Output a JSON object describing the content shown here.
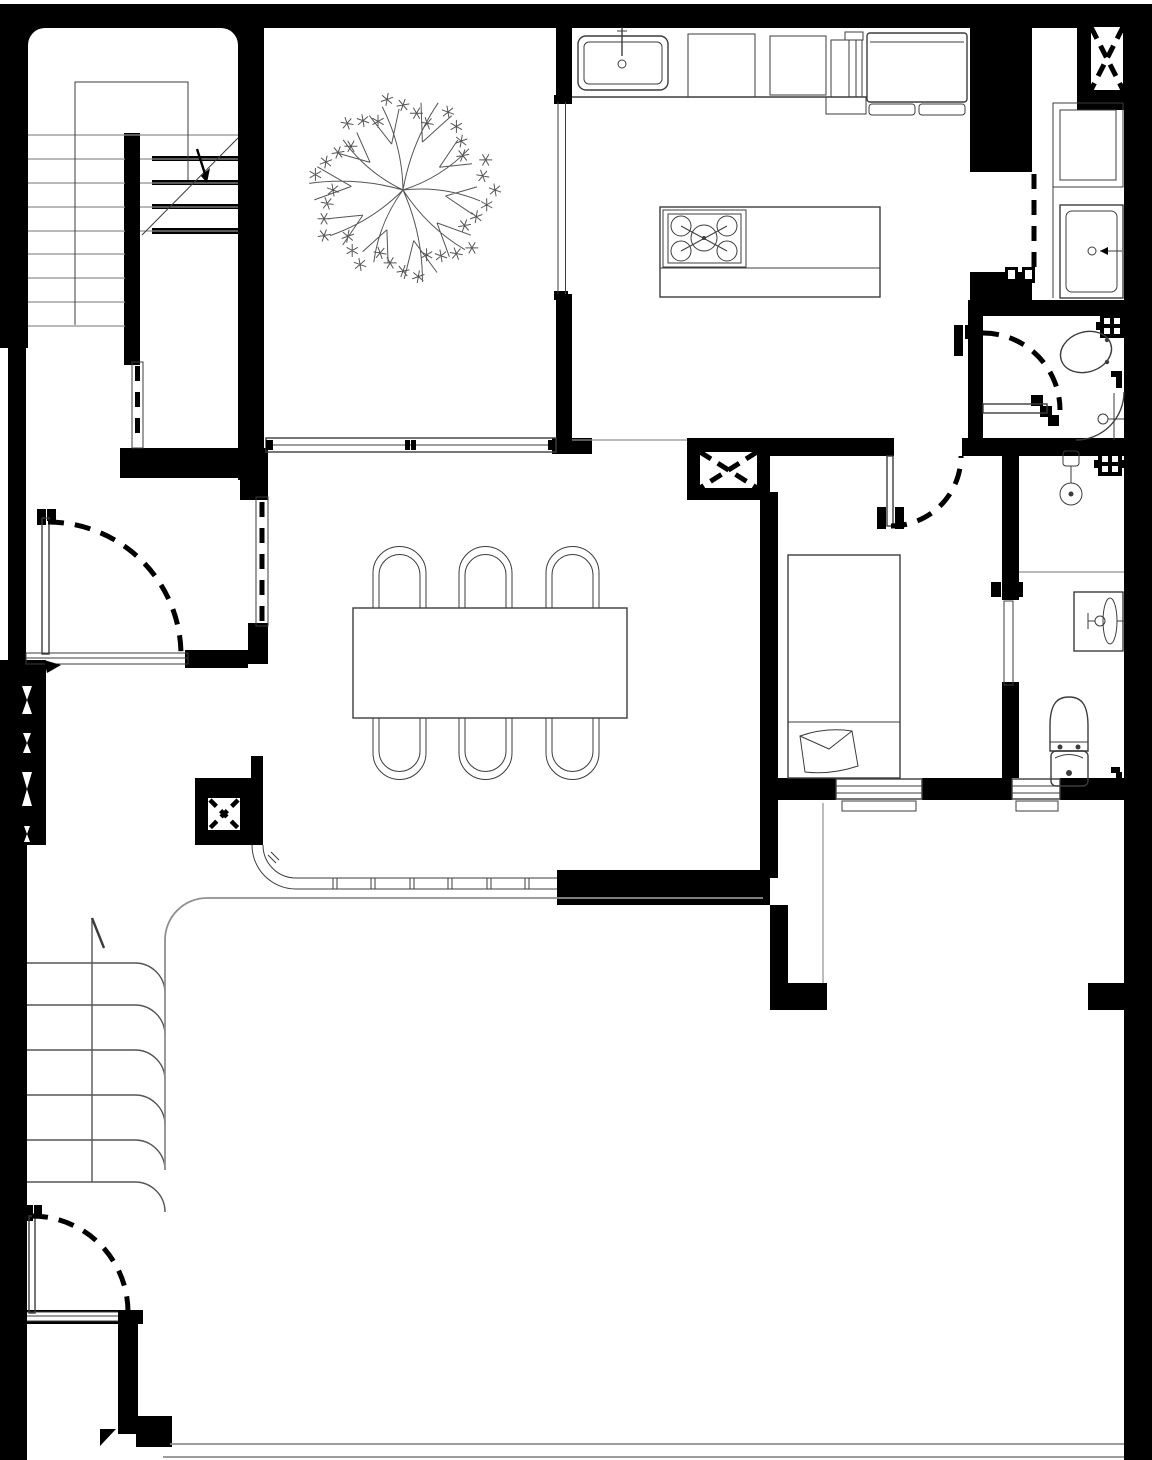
{
  "document": {
    "kind": "architectural floor plan",
    "drawing_style": "monochrome CAD line drawing",
    "visible_text": ""
  },
  "palette": {
    "background": "#ffffff",
    "wall": "#000000",
    "fixture_line": "#3d3d3d",
    "site_line": "#8f8f8f",
    "detail_line": "#555555"
  },
  "rooms": {
    "stair_hall": {
      "label": "staircase hall with U-stair and break line"
    },
    "entry": {
      "label": "entry vestibule with inward swing door"
    },
    "courtyard": {
      "label": "courtyard with large plan tree"
    },
    "kitchen": {
      "label": "kitchen with counter, sink, refrigerator and cooktop island"
    },
    "bath_top": {
      "label": "bathroom with vanity, tub-shower, duct shaft and sliding door"
    },
    "wc": {
      "label": "toilet room with toilet, corner shower and swing door"
    },
    "dining": {
      "label": "dining room with table for six and curved railing"
    },
    "bedroom": {
      "label": "bedroom with double bed, swing door and sliding door"
    },
    "bath_right": {
      "label": "bathroom with shower, basin vanity and toilet"
    },
    "terrace": {
      "label": "terrace behind bedroom"
    },
    "garden": {
      "label": "garden / yard with boundary lines"
    },
    "steps": {
      "label": "curved exterior steps with direction line"
    }
  },
  "symbols": {
    "shaft_x": "service shaft (rectangle with dashed X)",
    "column_marker": "column marker (small square with X)",
    "door_arc": "door swing shown as dashed quarter arc",
    "window": "window shown as double line with dark sashes",
    "grate": "floor grate / vent (black square with white dots)",
    "tree": "deciduous tree plan symbol with radial branches and star foliage"
  }
}
